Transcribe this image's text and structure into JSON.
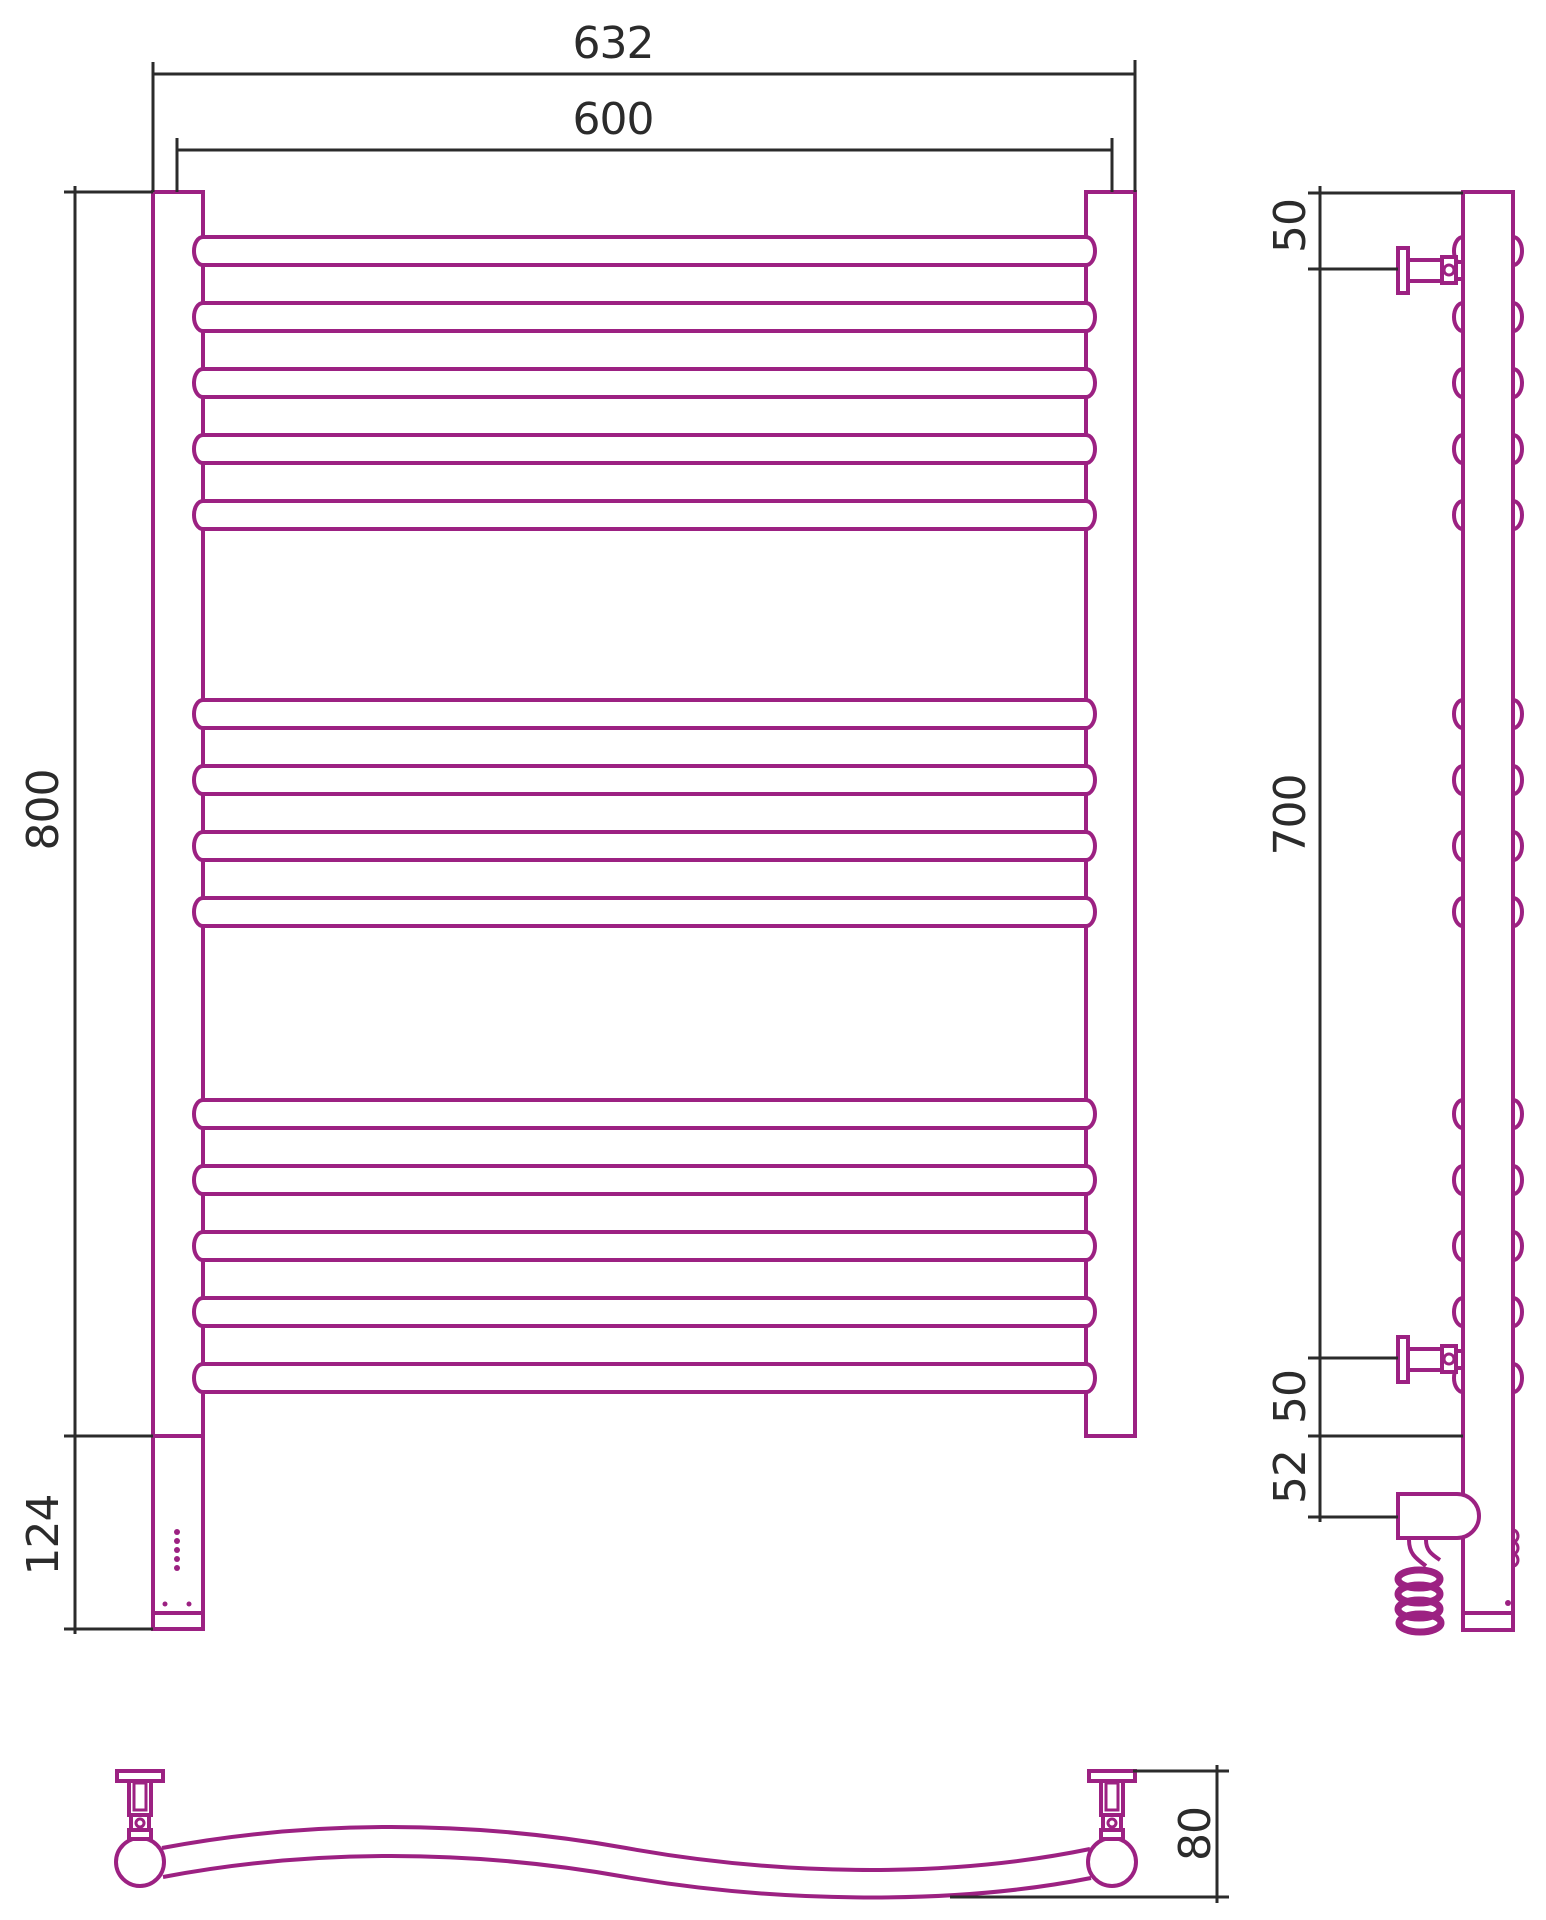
{
  "meta": {
    "type": "technical-drawing",
    "subject": "ladder towel rail with electric heating element, three orthographic views"
  },
  "colors": {
    "product_outline": "#9C2182",
    "dimension_lines": "#2B2B2B",
    "background": "#FFFFFF"
  },
  "views": {
    "front": {
      "rung_count": 14,
      "rung_groups": [
        5,
        4,
        5
      ],
      "labels": {
        "outer_width": "632",
        "tube_width": "600",
        "height": "800",
        "housing_height": "124"
      }
    },
    "side": {
      "bracket_count": 2,
      "labels": {
        "top_bracket_offset": "50",
        "bracket_span": "700",
        "bottom_bracket_offset": "50",
        "heater_offset": "52"
      }
    },
    "top": {
      "labels": {
        "depth": "80"
      }
    }
  }
}
